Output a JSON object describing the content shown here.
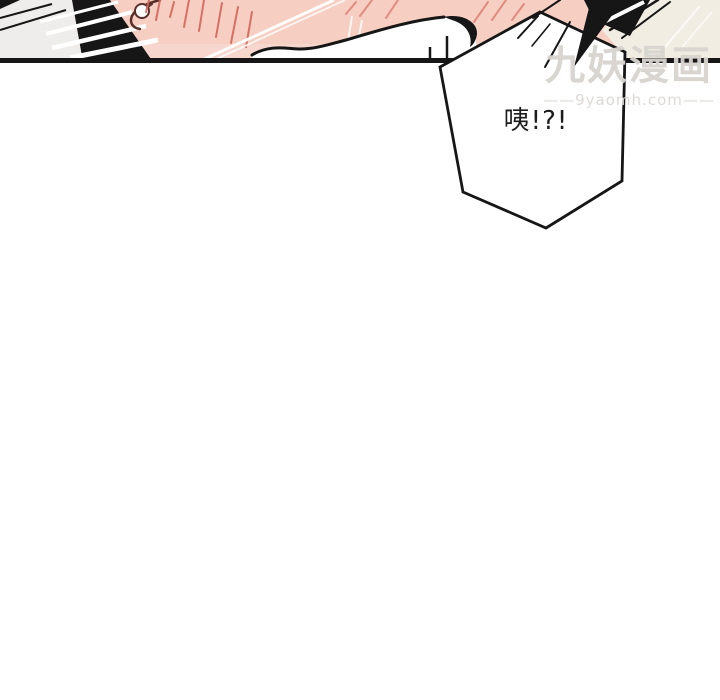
{
  "page": {
    "background": "#ffffff",
    "width": 720,
    "height": 700
  },
  "colors": {
    "ink": "#161616",
    "skin": "#f6cec2",
    "offwhite": "#efedeb",
    "cream": "#f2ede3",
    "blush": "#d5655b",
    "ear_line": "#5a2f2a",
    "bubble_fill": "#ffffff",
    "watermark_title": "#d8d4cf",
    "watermark_url": "#dcd8d3",
    "text": "#1c1c1c"
  },
  "panel": {
    "bubble": {
      "text": "咦!?!"
    }
  },
  "watermark": {
    "title": "九妖漫画",
    "url": "——9yaomh.com——"
  }
}
